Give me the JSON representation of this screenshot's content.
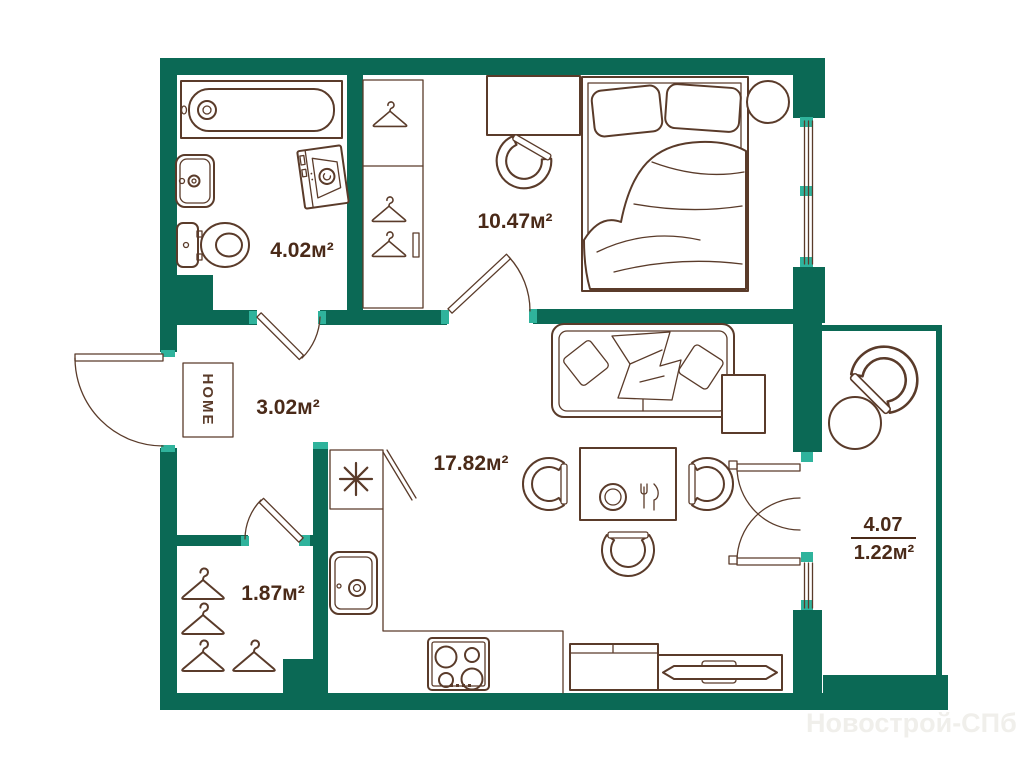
{
  "theme": {
    "wall": "#0b6955",
    "accent": "#2fb39c",
    "line": "#5a3b2a",
    "label": "#4a2a18",
    "watermark": "#f0efeb",
    "canvas": "#ffffff"
  },
  "floorplan": {
    "rooms": {
      "bathroom": {
        "area": "4.02м²"
      },
      "bedroom": {
        "area": "10.47м²"
      },
      "hallway": {
        "area": "3.02м²"
      },
      "living_kitchen": {
        "area": "17.82м²"
      },
      "closet": {
        "area": "1.87м²"
      },
      "balcony": {
        "area_full": "4.07",
        "area_reduced": "1.22м²"
      }
    },
    "entrance_mat": "HOME",
    "watermark": "Новострой-СПб"
  }
}
